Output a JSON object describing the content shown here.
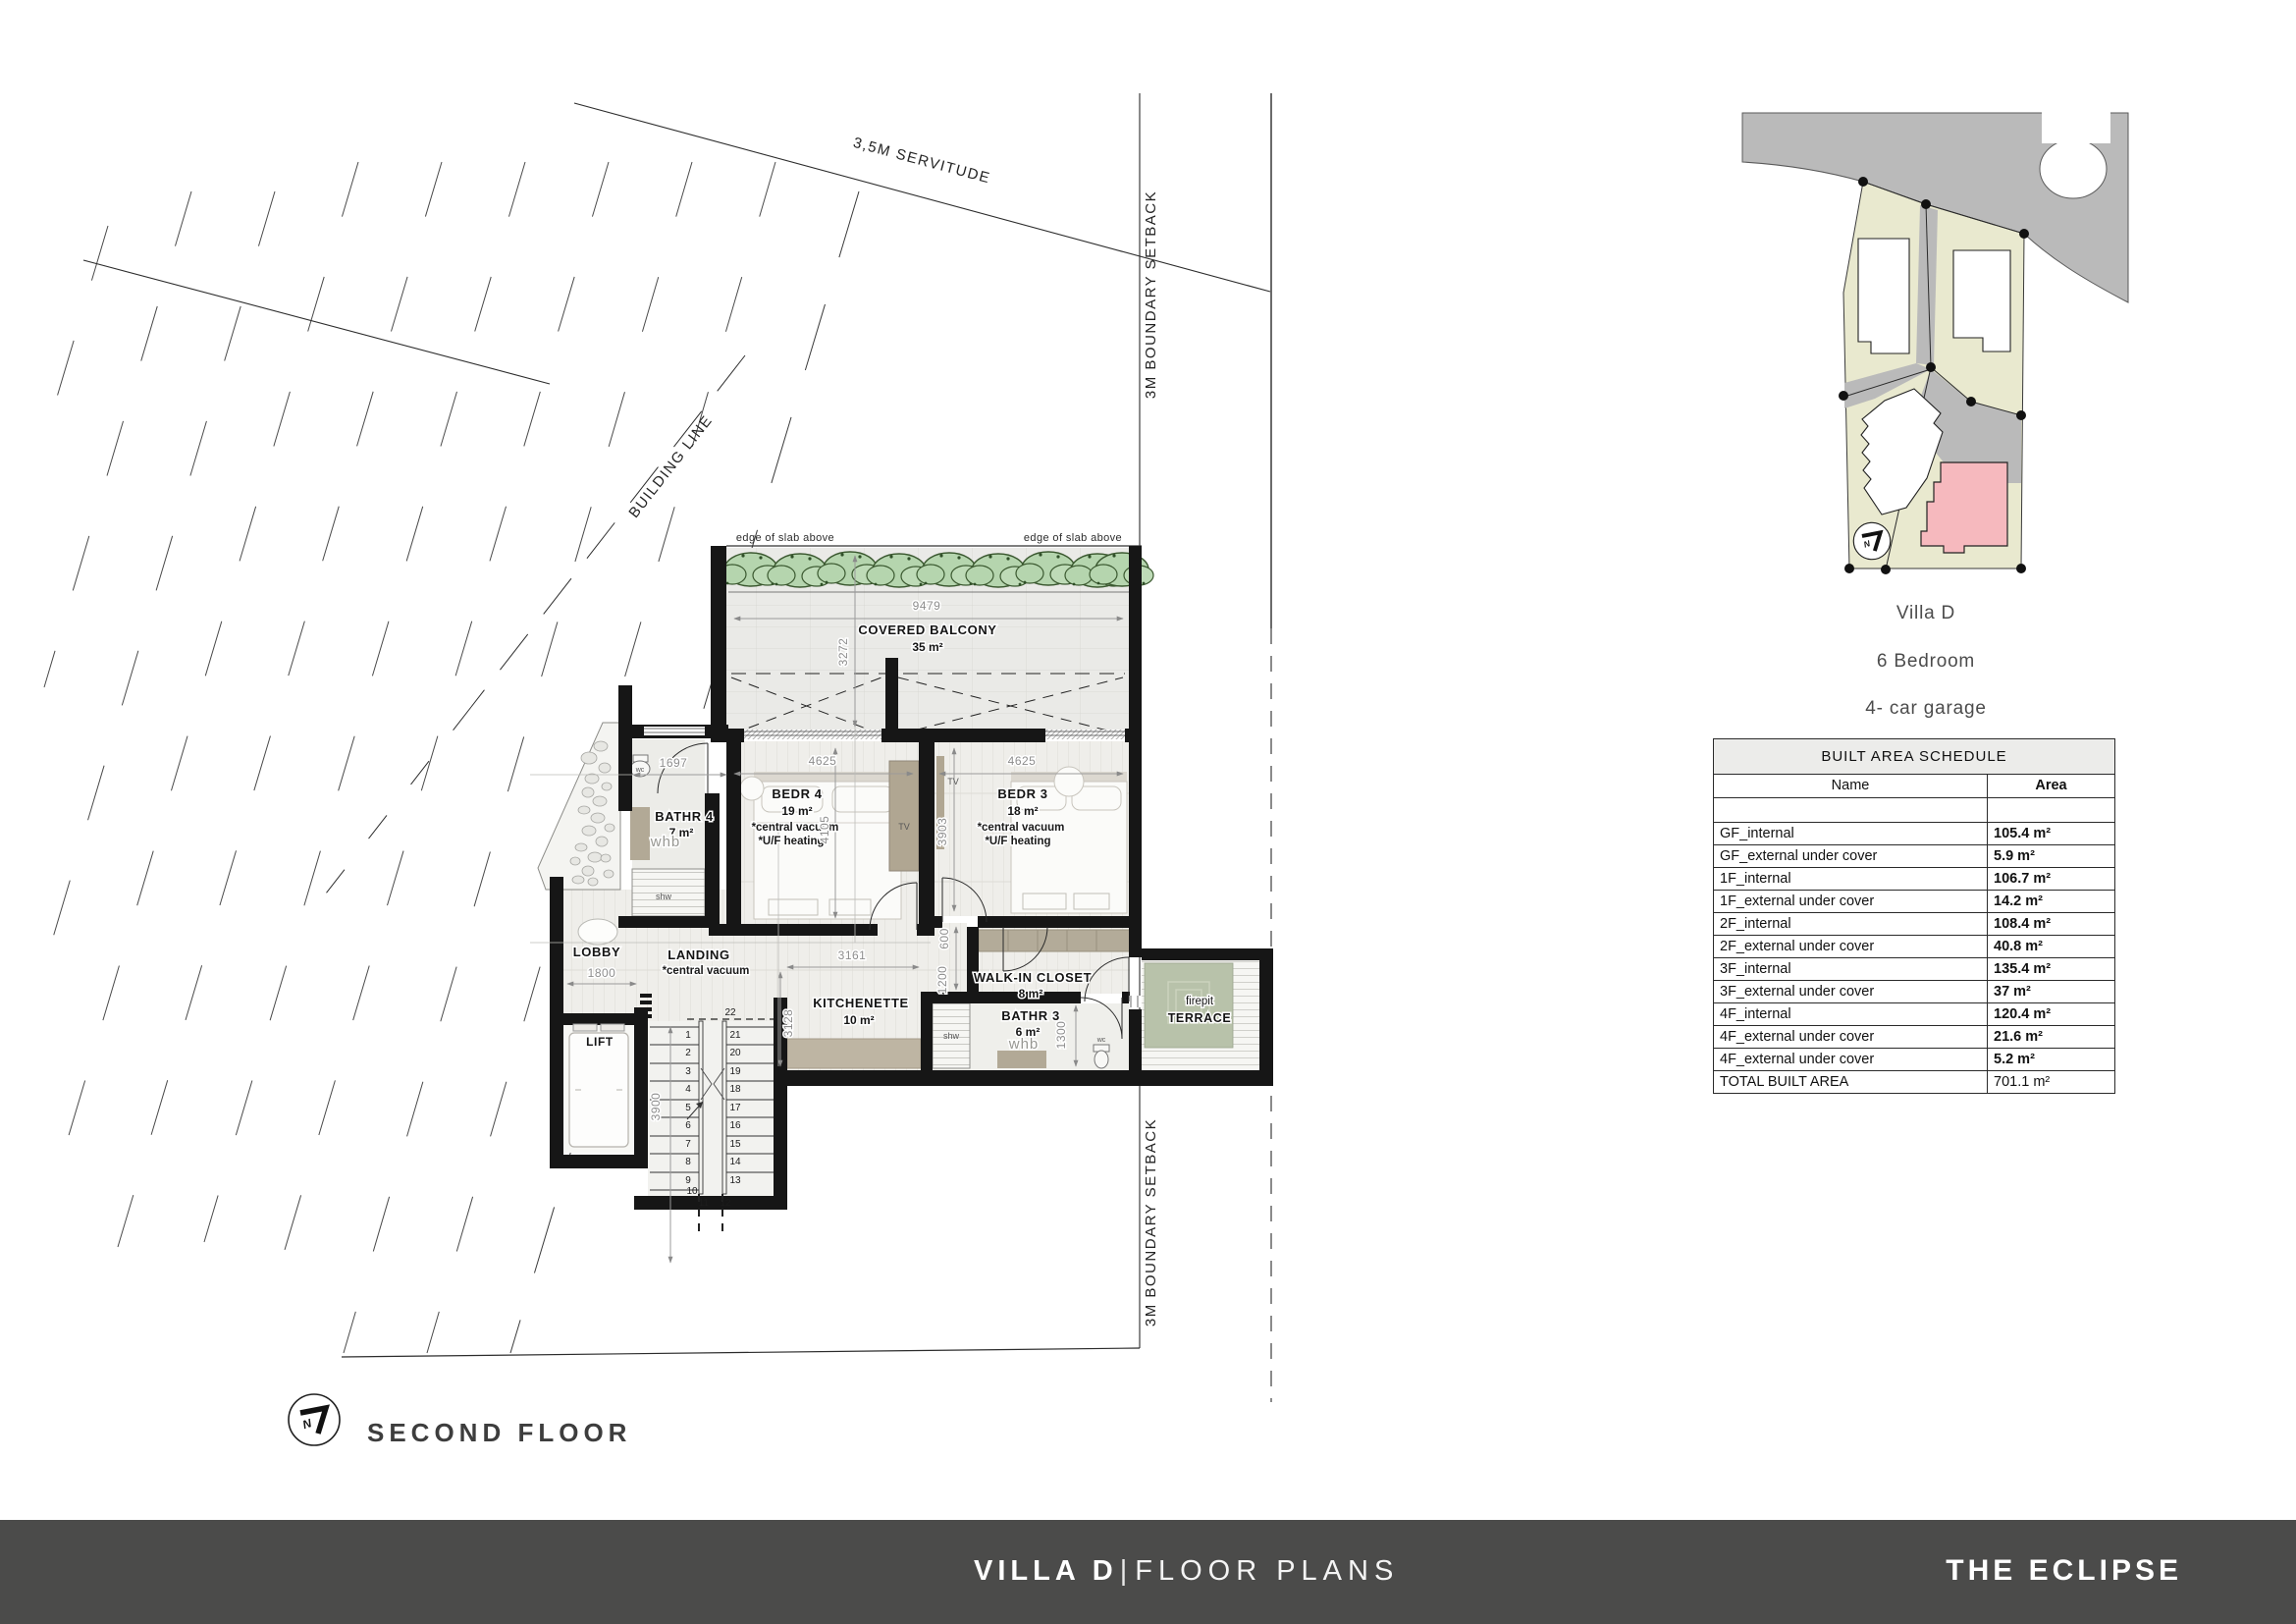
{
  "title_block": {
    "floor_label": "SECOND FLOOR"
  },
  "footer": {
    "project": "VILLA D",
    "separator": "|",
    "section": "FLOOR PLANS",
    "brand": "THE ECLIPSE"
  },
  "site_plan": {
    "villa": "Villa D",
    "bedrooms": "6 Bedroom",
    "garage": "4- car garage",
    "north_letter": "N",
    "highlight_color": "#f6b9be",
    "plot_color": "#e9e9cf",
    "road_color": "#bababa"
  },
  "boundaries": {
    "servitude": "3,5M SERVITUDE",
    "setback_top": "3M BOUNDARY SETBACK",
    "setback_bottom": "3M BOUNDARY SETBACK",
    "building_line": "BUILDING LINE",
    "slab_left": "edge of slab above",
    "slab_right": "edge of slab above"
  },
  "rooms": {
    "balcony": {
      "name": "COVERED BALCONY",
      "area": "35 m²"
    },
    "bedr4": {
      "name": "BEDR 4",
      "area": "19 m²",
      "note1": "*central vacuum",
      "note2": "*U/F heating",
      "tv": "TV"
    },
    "bedr3": {
      "name": "BEDR 3",
      "area": "18 m²",
      "note1": "*central vacuum",
      "note2": "*U/F heating",
      "tv": "TV"
    },
    "bathr4": {
      "name": "BATHR 4",
      "area": "7 m²",
      "whb": "whb",
      "wc": "wc",
      "shw": "shw"
    },
    "bathr3": {
      "name": "BATHR 3",
      "area": "6 m²",
      "whb": "whb",
      "wc": "wc",
      "shw": "shw"
    },
    "lobby": {
      "name": "LOBBY"
    },
    "landing": {
      "name": "LANDING",
      "note1": "*central vacuum"
    },
    "kitchenette": {
      "name": "KITCHENETTE",
      "area": "10 m²"
    },
    "walkin": {
      "name": "WALK-IN CLOSET",
      "area": "8 m²"
    },
    "terrace": {
      "line1": "firepit",
      "line2": "TERRACE"
    },
    "lift": {
      "name": "LIFT"
    }
  },
  "dims": {
    "balcony_w": "9479",
    "balcony_d": "3272",
    "bedr4_w": "4625",
    "bedr4_d": "4105",
    "bedr3_w": "4625",
    "bedr3_d": "3903",
    "bathr4_w": "1697",
    "lobby_w": "1800",
    "landing_w": "3161",
    "kitchen_d": "3128",
    "walkin_a": "600",
    "walkin_b": "1200",
    "bathr3_d": "1300",
    "stair_d": "3900"
  },
  "stairs": {
    "flight_a": [
      "1",
      "2",
      "3",
      "4",
      "5",
      "6",
      "7",
      "8",
      "9",
      "10"
    ],
    "flight_b": [
      "22",
      "21",
      "20",
      "19",
      "18",
      "17",
      "16",
      "15",
      "14",
      "13"
    ],
    "mid": [
      "11",
      "12"
    ]
  },
  "schedule": {
    "title": "BUILT AREA SCHEDULE",
    "col_name": "Name",
    "col_area": "Area",
    "rows": [
      {
        "name": "GF_internal",
        "area": "105.4 m²"
      },
      {
        "name": "GF_external under cover",
        "area": "5.9 m²"
      },
      {
        "name": "1F_internal",
        "area": "106.7 m²"
      },
      {
        "name": "1F_external under cover",
        "area": "14.2 m²"
      },
      {
        "name": "2F_internal",
        "area": "108.4 m²"
      },
      {
        "name": "2F_external under cover",
        "area": "40.8 m²"
      },
      {
        "name": "3F_internal",
        "area": "135.4 m²"
      },
      {
        "name": "3F_external under cover",
        "area": "37 m²"
      },
      {
        "name": "4F_internal",
        "area": "120.4 m²"
      },
      {
        "name": "4F_external under cover",
        "area": "21.6 m²"
      },
      {
        "name": "4F_external under cover",
        "area": "5.2 m²"
      },
      {
        "name": "TOTAL BUILT AREA",
        "area": "701.1 m²"
      }
    ]
  },
  "colors": {
    "footer_bg": "#4b4b4a",
    "terrace_green": "#b8c2aa",
    "bush_green": "#b5d5ae"
  }
}
